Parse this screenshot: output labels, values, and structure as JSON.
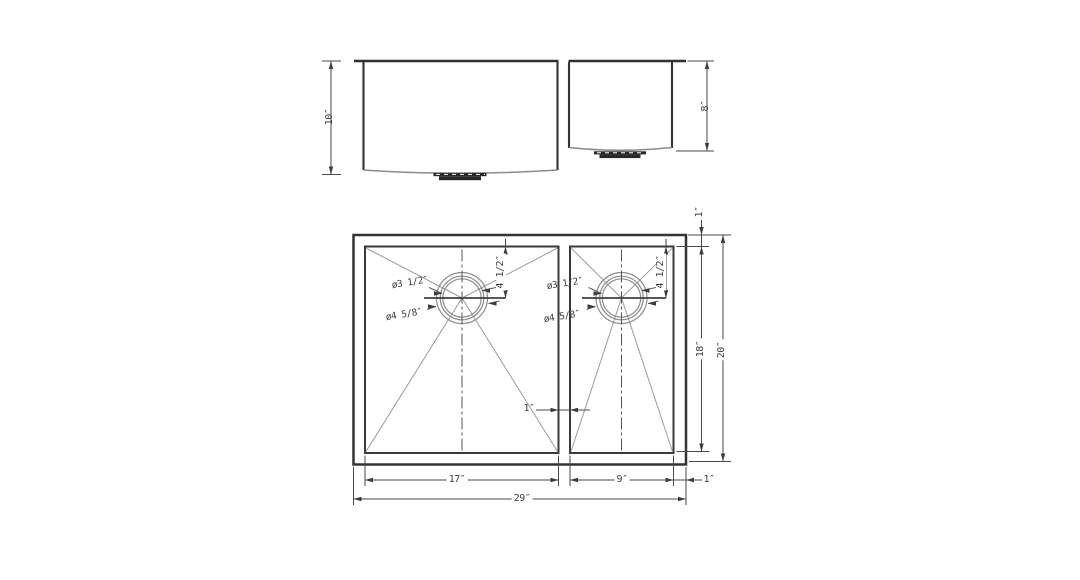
{
  "colors": {
    "line_dark": "#3a3a3a",
    "line_dim": "#4a4a4a",
    "line_light": "#9c9c9c",
    "text": "#3f3f3f",
    "background": "#ffffff"
  },
  "front_view": {
    "left_bowl_depth": "10″",
    "right_bowl_depth": "8″"
  },
  "plan_view": {
    "overall_width": "29″",
    "left_bowl_width": "17″",
    "right_bowl_width": "9″",
    "right_rim_width": "1″",
    "top_rim_width": "1″",
    "divider_width": "1″",
    "inner_depth": "18″",
    "overall_depth": "20″",
    "left_drain": {
      "drain_offset": "4 1/2″",
      "inner_diameter": "ø3 1/2″",
      "outer_diameter": "ø4 5/8″"
    },
    "right_drain": {
      "drain_offset": "4 1/2″",
      "inner_diameter": "ø3 1/2″",
      "outer_diameter": "ø4 5/8″"
    }
  }
}
